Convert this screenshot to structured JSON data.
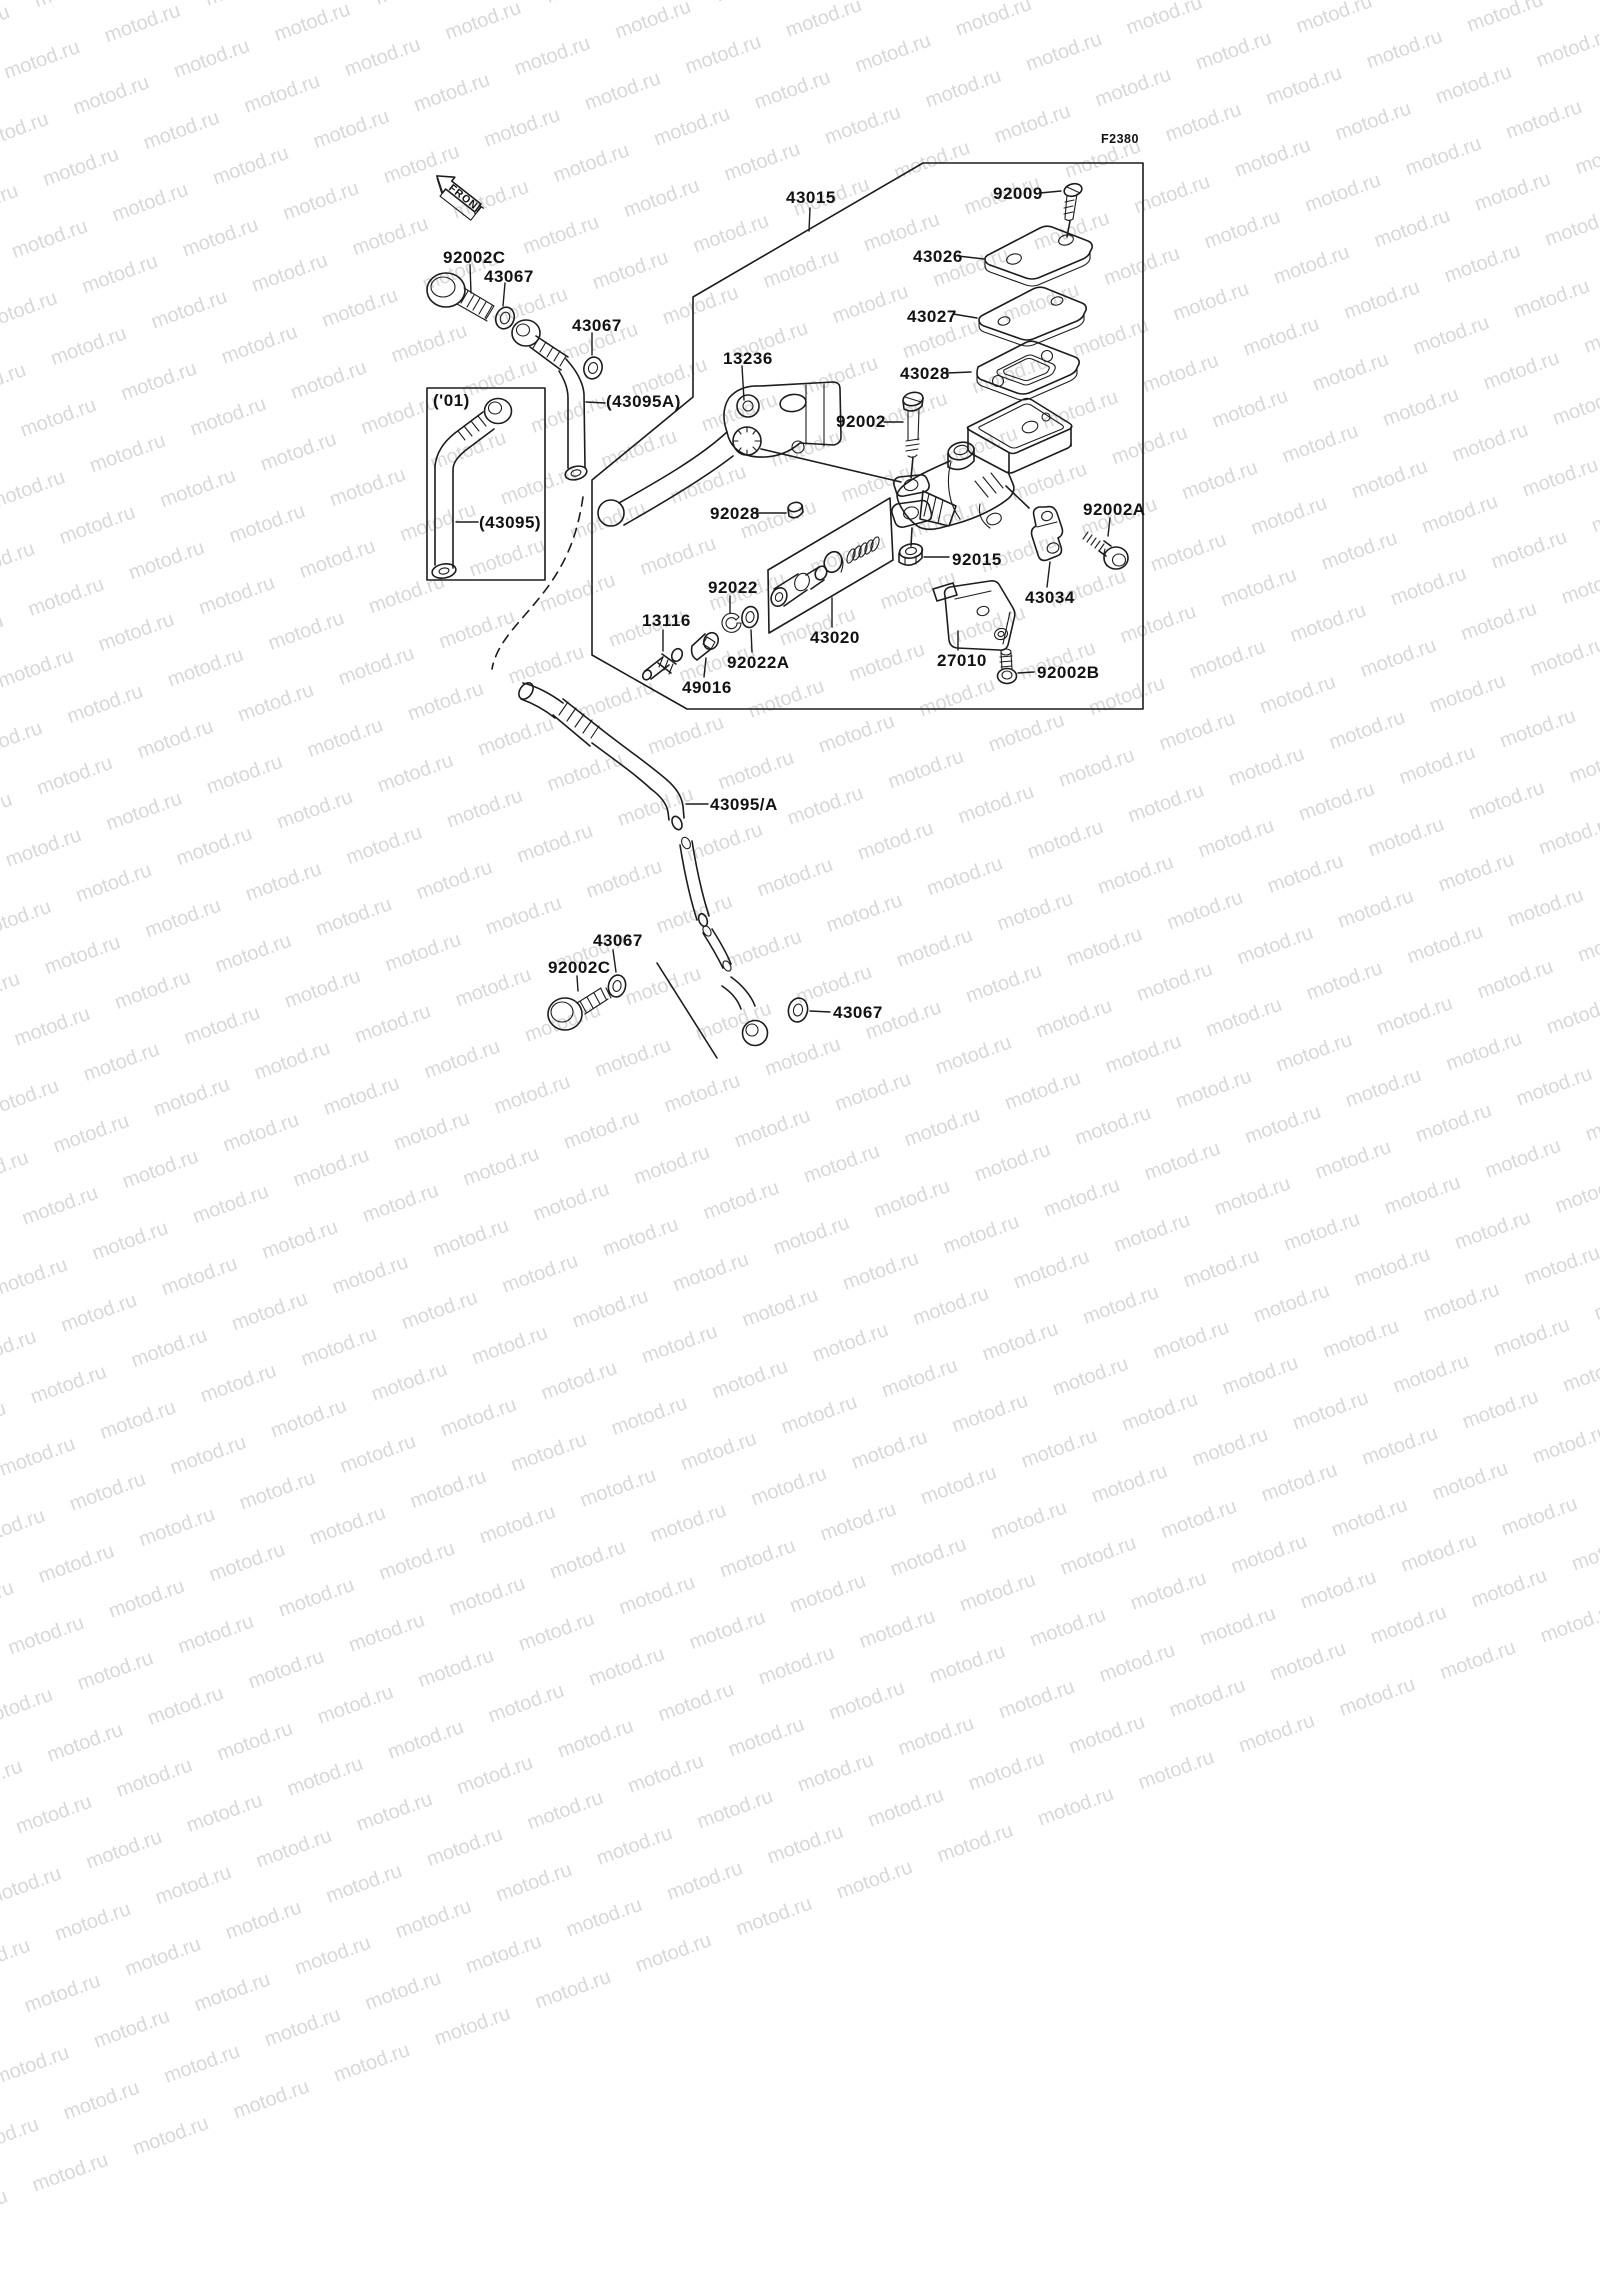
{
  "diagram": {
    "figure_code": "F2380",
    "front_label": "FRONT",
    "ink_color": "#1c1c1c",
    "watermark": {
      "text": "motod.ru",
      "color": "#d8d8d8"
    },
    "labels": [
      {
        "text": "43015",
        "x": 786,
        "y": 189,
        "leader": [
          810,
          208,
          809,
          231
        ]
      },
      {
        "text": "92009",
        "x": 993,
        "y": 185,
        "leader": [
          1040,
          193,
          1061,
          191
        ]
      },
      {
        "text": "43026",
        "x": 913,
        "y": 248,
        "leader": [
          958,
          256,
          984,
          259
        ]
      },
      {
        "text": "43027",
        "x": 907,
        "y": 308,
        "leader": [
          953,
          314,
          977,
          318
        ]
      },
      {
        "text": "43028",
        "x": 900,
        "y": 365,
        "leader": [
          947,
          373,
          971,
          372
        ]
      },
      {
        "text": "92002",
        "x": 836,
        "y": 413,
        "leader": [
          884,
          422,
          903,
          422
        ]
      },
      {
        "text": "13236",
        "x": 723,
        "y": 350,
        "leader": [
          742,
          366,
          744,
          400
        ]
      },
      {
        "text": "92002C",
        "x": 443,
        "y": 249,
        "leader": [
          470,
          265,
          471,
          293
        ]
      },
      {
        "text": "43067",
        "x": 484,
        "y": 268,
        "leader": [
          505,
          283,
          503,
          306
        ]
      },
      {
        "text": "43067",
        "x": 572,
        "y": 317,
        "leader": [
          592,
          333,
          592,
          355
        ]
      },
      {
        "text": "(43095A)",
        "x": 606,
        "y": 393,
        "leader": [
          605,
          403,
          586,
          402
        ]
      },
      {
        "text": "('01)",
        "x": 433,
        "y": 392,
        "leader": null
      },
      {
        "text": "(43095)",
        "x": 479,
        "y": 514,
        "leader": [
          478,
          522,
          456,
          522
        ]
      },
      {
        "text": "92028",
        "x": 710,
        "y": 505,
        "leader": [
          757,
          513,
          786,
          513
        ]
      },
      {
        "text": "92015",
        "x": 952,
        "y": 551,
        "leader": [
          949,
          557,
          924,
          557
        ]
      },
      {
        "text": "92002A",
        "x": 1083,
        "y": 501,
        "leader": [
          1110,
          518,
          1108,
          536
        ]
      },
      {
        "text": "43034",
        "x": 1025,
        "y": 589,
        "leader": [
          1047,
          587,
          1050,
          562
        ]
      },
      {
        "text": "92022",
        "x": 708,
        "y": 579,
        "leader": [
          730,
          596,
          730,
          613
        ]
      },
      {
        "text": "13116",
        "x": 642,
        "y": 612,
        "leader": [
          663,
          630,
          663,
          651
        ]
      },
      {
        "text": "92022A",
        "x": 727,
        "y": 654,
        "leader": [
          752,
          652,
          751,
          630
        ]
      },
      {
        "text": "49016",
        "x": 682,
        "y": 679,
        "leader": [
          704,
          677,
          706,
          658
        ]
      },
      {
        "text": "43020",
        "x": 810,
        "y": 629,
        "leader": [
          832,
          627,
          832,
          598
        ]
      },
      {
        "text": "27010",
        "x": 937,
        "y": 652,
        "leader": [
          958,
          650,
          958,
          631
        ]
      },
      {
        "text": "92002B",
        "x": 1037,
        "y": 664,
        "leader": [
          1034,
          672,
          1018,
          673
        ]
      },
      {
        "text": "43095/A",
        "x": 710,
        "y": 796,
        "leader": [
          708,
          804,
          686,
          804
        ]
      },
      {
        "text": "43067",
        "x": 593,
        "y": 932,
        "leader": [
          613,
          950,
          616,
          972
        ]
      },
      {
        "text": "92002C",
        "x": 548,
        "y": 959,
        "leader": [
          577,
          976,
          578,
          991
        ]
      },
      {
        "text": "43067",
        "x": 833,
        "y": 1004,
        "leader": [
          830,
          1012,
          810,
          1011
        ]
      }
    ]
  }
}
